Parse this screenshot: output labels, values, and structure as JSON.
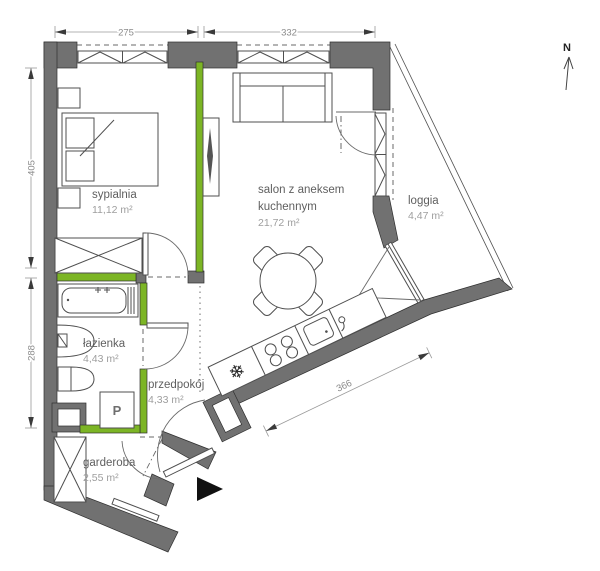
{
  "plan": {
    "north_label": "N",
    "rooms": [
      {
        "id": "sypialnia",
        "name": "sypialnia",
        "area": "11,12 m²"
      },
      {
        "id": "salon",
        "line1": "salon z aneksem",
        "line2": "kuchennym",
        "area": "21,72 m²"
      },
      {
        "id": "loggia",
        "name": "loggia",
        "area": "4,47 m²"
      },
      {
        "id": "lazienka",
        "name": "łazienka",
        "area": "4,43 m²"
      },
      {
        "id": "przedpokoj",
        "name": "przedpokój",
        "area": "4,33 m²"
      },
      {
        "id": "garderoba",
        "name": "garderoba",
        "area": "2,55 m²"
      }
    ],
    "dimensions": {
      "top_left": "275",
      "top_right": "332",
      "left_upper": "405",
      "left_lower": "288",
      "diagonal": "366"
    },
    "appliances": {
      "washer_label": "P",
      "fridge_icon": "snowflake"
    },
    "colors": {
      "wall": "#717171",
      "accent_green": "#7cb525",
      "dim_text": "#8a8a8a",
      "room_name": "#5f5f5f",
      "room_area": "#9e9e9e"
    }
  }
}
